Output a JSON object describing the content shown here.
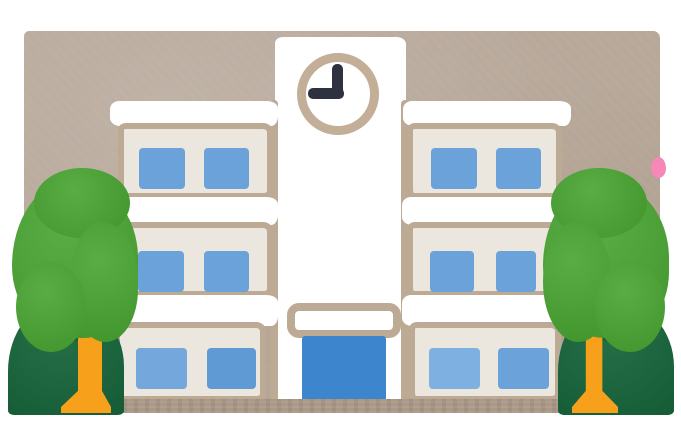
{
  "scene": {
    "subject": "school building illustration",
    "style": "hand-drawn watercolor clipart on white page with tan background panel",
    "clock": {
      "time": "9:00",
      "minute_hand_points": "12",
      "hour_hand_points": "9"
    },
    "building": {
      "has_clock_tower": true,
      "wings": 2,
      "floors_per_wing": 3,
      "windows_per_floor_per_wing": 2,
      "total_windows": 12,
      "entrance": {
        "door": "large blue doorway",
        "sign": "blank rounded outline above door"
      }
    },
    "trees": {
      "left": {
        "front": "round light-green tree with orange trunk",
        "back": "dark-green tree at corner"
      },
      "right": {
        "front": "round light-green tree with orange trunk",
        "back": "dark-green tree at corner"
      },
      "pink_blossom_peeking_at_right_edge": true
    }
  },
  "colors": {
    "page": "#ffffff",
    "sky": "#b7a89a",
    "building-white": "#ffffff",
    "wall": "#ebe6de",
    "outline": "#bcaa95",
    "window-a": "#6ba2d9",
    "window-b": "#5f9ad5",
    "window-c": "#7fb0e2",
    "window-d": "#74a8dc",
    "door": "#3d86cd",
    "tree-light": "#46a32f",
    "tree-dark": "#17663c",
    "trunk": "#f6a01b",
    "clock-ring": "#c3ae98",
    "clock-hands": "#2d3140",
    "ground": "#ab9987",
    "pink": "#f688b8"
  }
}
